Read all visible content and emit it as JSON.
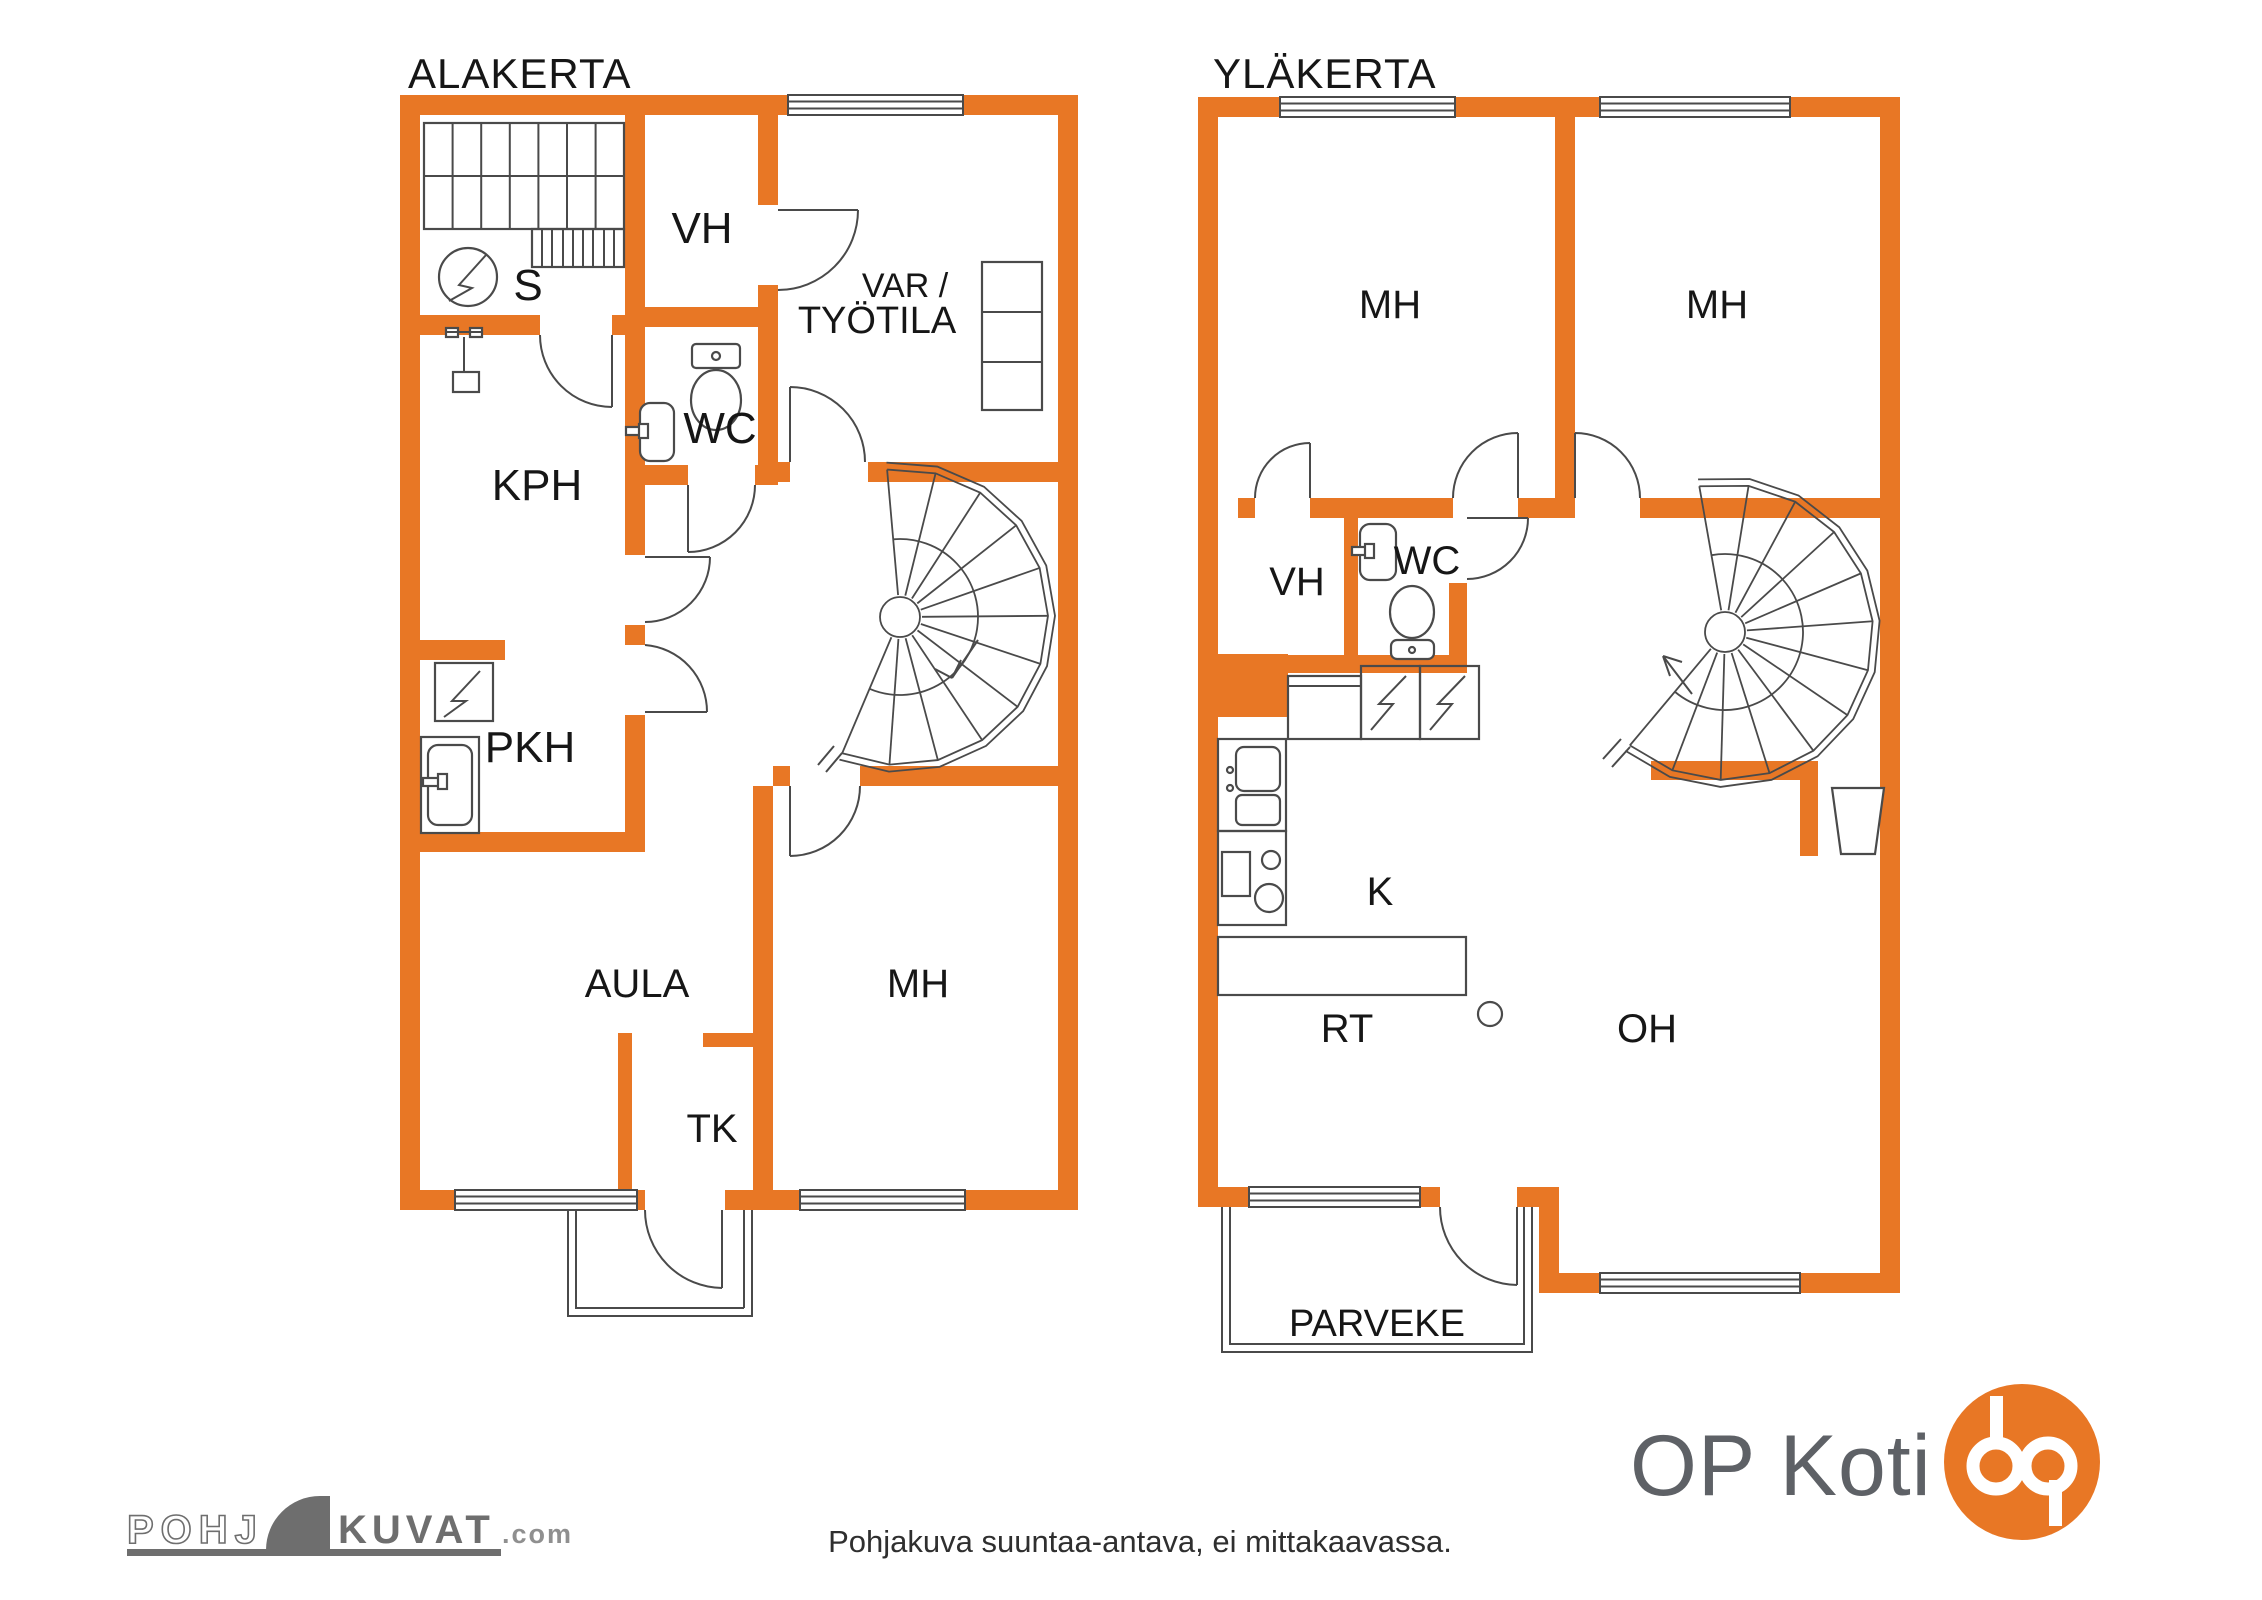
{
  "colors": {
    "wall": "#E87725",
    "line": "#4A4A4A",
    "ink": "#161616",
    "logo_gray": "#6E6E6E",
    "logo_light": "#8F8F8F",
    "op_text": "#5E6166",
    "op_orange": "#E87725"
  },
  "floor_left": {
    "title": "ALAKERTA",
    "rooms": {
      "sauna": "S",
      "closet": "VH",
      "storage_line1": "VAR /",
      "storage_line2": "TYÖTILA",
      "wc": "WC",
      "bathroom": "KPH",
      "laundry": "PKH",
      "hall": "AULA",
      "bedroom": "MH",
      "vestibule": "TK"
    }
  },
  "floor_right": {
    "title": "YLÄKERTA",
    "rooms": {
      "bedroom1": "MH",
      "bedroom2": "MH",
      "closet": "VH",
      "wc": "WC",
      "kitchen": "K",
      "dining": "RT",
      "living": "OH",
      "balcony": "PARVEKE"
    }
  },
  "footer": {
    "disclaimer": "Pohjakuva suuntaa-antava, ei mittakaavassa.",
    "pohjakuvat_logo": {
      "part1": "POHJ",
      "part2": "KUVAT",
      "part3": ".com"
    },
    "op_koti": {
      "label": "OP Koti"
    }
  }
}
